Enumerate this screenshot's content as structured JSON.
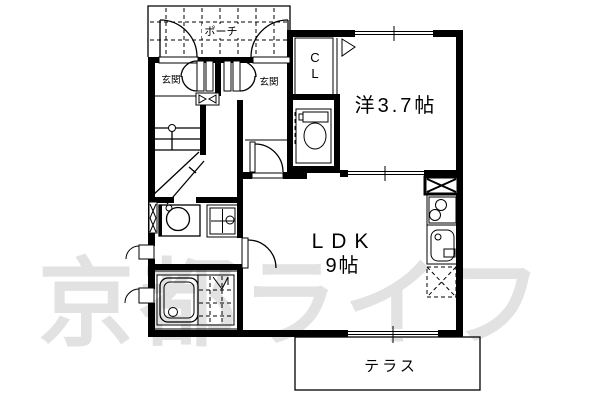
{
  "page": {
    "type": "floor-plan"
  },
  "watermark": {
    "text": "京都ライフ",
    "color": "#e2e2e2"
  },
  "labels": {
    "porch": "ポーチ",
    "entrance_left": "玄関",
    "entrance_right": "玄関",
    "closet_line1": "C",
    "closet_line2": "L",
    "western_room": "洋3.7帖",
    "ldk_line1": "LDK",
    "ldk_line2": "9帖",
    "terrace": "テラス"
  },
  "colors": {
    "wall": "#000000",
    "background": "#ffffff",
    "watermark": "#e2e2e2"
  }
}
